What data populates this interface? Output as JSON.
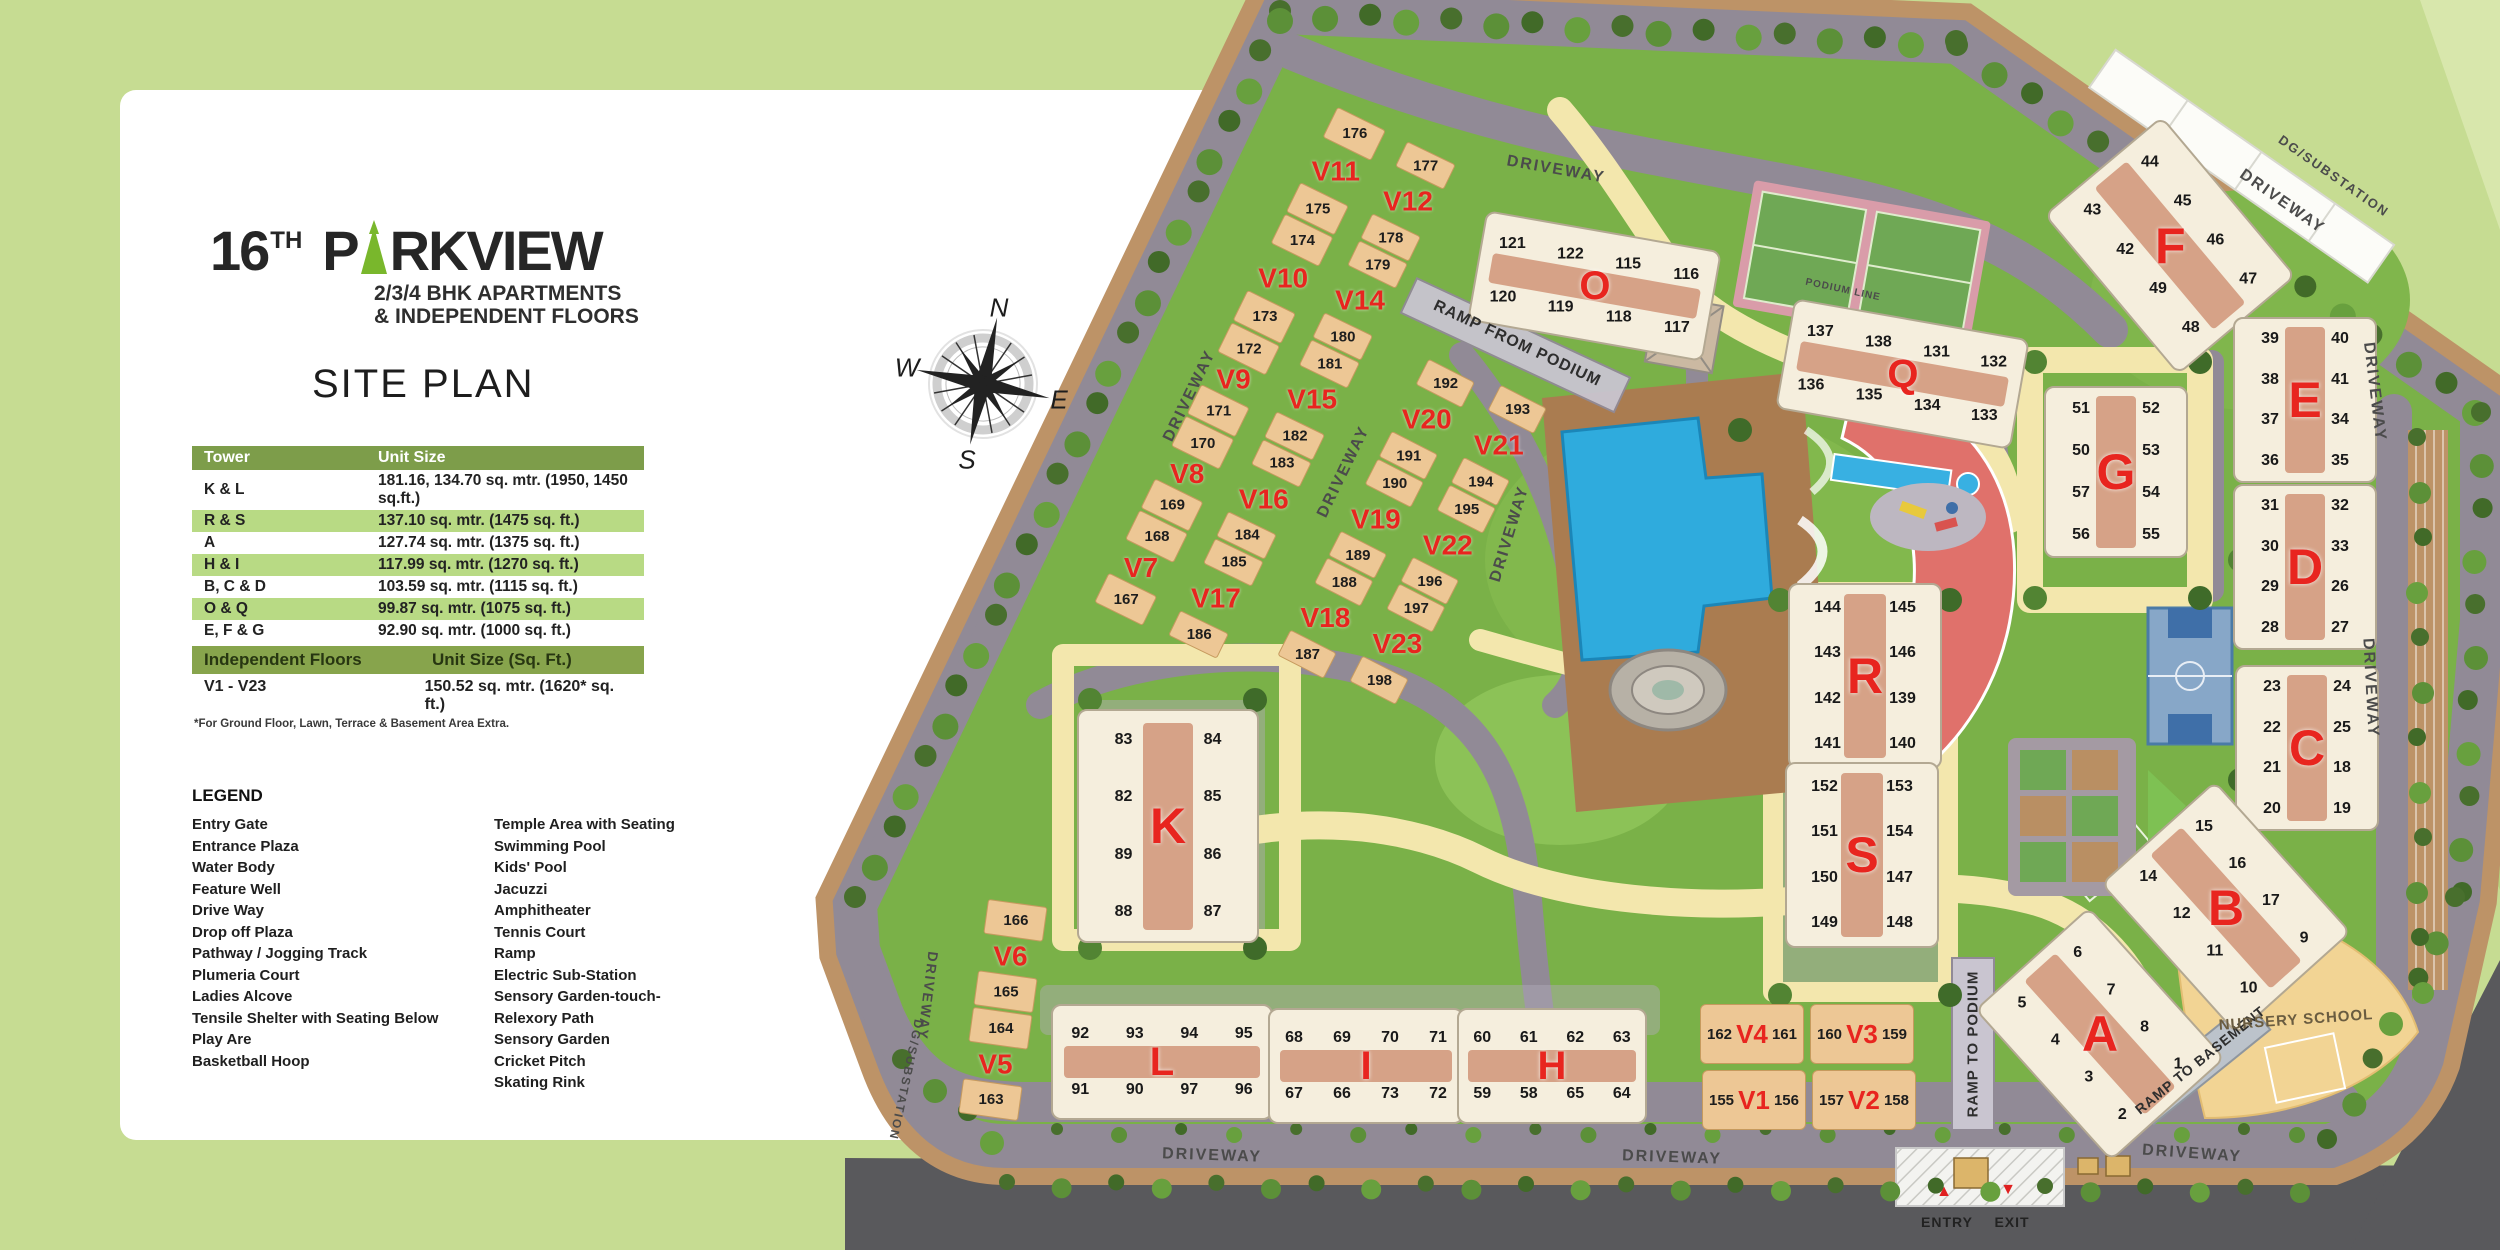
{
  "branding": {
    "title_num": "16",
    "title_sup": "TH",
    "title_p": "P",
    "title_rest": "RKVIEW",
    "subtitle1": "2/3/4 BHK APARTMENTS",
    "subtitle2": "& INDEPENDENT FLOORS",
    "accent_green": "#79b72c"
  },
  "site_plan_title": "SITE PLAN",
  "tower_table": {
    "headers": [
      "Tower",
      "Unit Size"
    ],
    "rows": [
      [
        "K & L",
        "181.16, 134.70 sq. mtr. (1950, 1450 sq.ft.)"
      ],
      [
        "R & S",
        "137.10 sq. mtr. (1475 sq. ft.)"
      ],
      [
        "A",
        "127.74 sq. mtr. (1375 sq. ft.)"
      ],
      [
        "H & I",
        "117.99 sq. mtr. (1270 sq. ft.)"
      ],
      [
        "B, C & D",
        "103.59 sq. mtr. (1115 sq. ft.)"
      ],
      [
        "O & Q",
        "99.87 sq. mtr. (1075 sq. ft.)"
      ],
      [
        "E, F & G",
        "92.90 sq. mtr. (1000 sq. ft.)"
      ]
    ]
  },
  "floors_table": {
    "header_left": "Independent Floors",
    "header_right": "Unit Size (Sq. Ft.)",
    "range": "V1 - V23",
    "size": "150.52 sq. mtr. (1620* sq. ft.)",
    "footnote": "*For Ground Floor, Lawn, Terrace & Basement Area Extra."
  },
  "legend": {
    "title": "LEGEND",
    "col1": [
      "Entry Gate",
      "Entrance Plaza",
      "Water Body",
      "Feature Well",
      "Drive Way",
      "Drop off Plaza",
      "Pathway / Jogging Track",
      "Plumeria Court",
      "Ladies Alcove",
      "Tensile Shelter with Seating Below",
      "Play Are",
      "Basketball Hoop"
    ],
    "col2": [
      "Temple Area with Seating",
      "Swimming Pool",
      "Kids' Pool",
      "Jacuzzi",
      "Amphitheater",
      "Tennis Court",
      "Ramp",
      "Electric Sub-Station",
      "Sensory Garden-touch-",
      "Relexory Path",
      "Sensory Garden",
      "Cricket Pitch",
      "Skating Rink"
    ]
  },
  "compass": {
    "n": "N",
    "e": "E",
    "s": "S",
    "w": "W"
  },
  "map": {
    "colors": {
      "lawn": "#7ab148",
      "road": "#918a96",
      "parking": "#bd9367",
      "track": "#f3e7ad",
      "building_tan": "#edc795",
      "tower_cream": "#f5eedd",
      "label_red": "#e8251f",
      "pool_blue": "#2fabdd",
      "clubhouse_red": "#e0716b",
      "dark_road": "#59595c"
    },
    "towers": [
      {
        "label": "O",
        "x": 1592,
        "y": 284,
        "w": 235,
        "h": 108,
        "a": 10,
        "cols": 4,
        "nums": [
          "121",
          "122",
          "115",
          "116",
          "120",
          "119",
          "118",
          "117"
        ]
      },
      {
        "label": "Q",
        "x": 1900,
        "y": 372,
        "w": 235,
        "h": 108,
        "a": 10,
        "cols": 4,
        "nums": [
          "137",
          "138",
          "131",
          "132",
          "136",
          "135",
          "134",
          "133"
        ]
      },
      {
        "label": "F",
        "x": 2168,
        "y": 243,
        "w": 150,
        "h": 205,
        "a": -40,
        "cols": 2,
        "nums": [
          "43",
          "44",
          "42",
          "45",
          "49",
          "46",
          "48",
          "47"
        ]
      },
      {
        "label": "E",
        "x": 2303,
        "y": 398,
        "w": 140,
        "h": 162,
        "a": 0,
        "cols": 2,
        "nums": [
          "39",
          "40",
          "38",
          "41",
          "37",
          "34",
          "36",
          "35"
        ]
      },
      {
        "label": "G",
        "x": 2114,
        "y": 470,
        "w": 140,
        "h": 168,
        "a": 0,
        "cols": 2,
        "nums": [
          "51",
          "52",
          "50",
          "53",
          "57",
          "54",
          "56",
          "55"
        ]
      },
      {
        "label": "D",
        "x": 2303,
        "y": 565,
        "w": 140,
        "h": 162,
        "a": 0,
        "cols": 2,
        "nums": [
          "31",
          "32",
          "30",
          "33",
          "29",
          "26",
          "28",
          "27"
        ]
      },
      {
        "label": "C",
        "x": 2305,
        "y": 746,
        "w": 140,
        "h": 162,
        "a": 0,
        "cols": 2,
        "nums": [
          "23",
          "24",
          "22",
          "25",
          "21",
          "18",
          "20",
          "19"
        ]
      },
      {
        "label": "B",
        "x": 2224,
        "y": 906,
        "w": 150,
        "h": 200,
        "a": -42,
        "cols": 2,
        "nums": [
          "14",
          "15",
          "12",
          "16",
          "11",
          "17",
          "10",
          "9"
        ]
      },
      {
        "label": "A",
        "x": 2098,
        "y": 1032,
        "w": 150,
        "h": 200,
        "a": -42,
        "cols": 2,
        "nums": [
          "5",
          "6",
          "4",
          "7",
          "3",
          "8",
          "2",
          "1"
        ]
      },
      {
        "label": "R",
        "x": 1863,
        "y": 674,
        "w": 150,
        "h": 182,
        "a": 0,
        "cols": 2,
        "nums": [
          "144",
          "145",
          "143",
          "146",
          "142",
          "139",
          "141",
          "140"
        ]
      },
      {
        "label": "S",
        "x": 1860,
        "y": 853,
        "w": 150,
        "h": 182,
        "a": 0,
        "cols": 2,
        "nums": [
          "152",
          "153",
          "151",
          "154",
          "150",
          "147",
          "149",
          "148"
        ]
      },
      {
        "label": "K",
        "x": 1166,
        "y": 824,
        "w": 178,
        "h": 230,
        "a": 0,
        "cols": 2,
        "nums": [
          "83",
          "84",
          "82",
          "85",
          "89",
          "86",
          "88",
          "87"
        ]
      },
      {
        "label": "L",
        "x": 1160,
        "y": 1060,
        "w": 218,
        "h": 112,
        "a": 0,
        "cols": 4,
        "nums": [
          "92",
          "93",
          "94",
          "95",
          "91",
          "90",
          "97",
          "96"
        ]
      },
      {
        "label": "I",
        "x": 1364,
        "y": 1064,
        "w": 192,
        "h": 112,
        "a": 0,
        "cols": 4,
        "nums": [
          "68",
          "69",
          "70",
          "71",
          "67",
          "66",
          "73",
          "72"
        ]
      },
      {
        "label": "H",
        "x": 1550,
        "y": 1064,
        "w": 186,
        "h": 112,
        "a": 0,
        "cols": 4,
        "nums": [
          "60",
          "61",
          "62",
          "63",
          "59",
          "58",
          "65",
          "64"
        ]
      }
    ],
    "v_strips": [
      {
        "x1": 1118,
        "y1": 615,
        "x2": 1362,
        "y2": 118,
        "w": 56,
        "items": [
          "167",
          "V7",
          "168",
          "169",
          "V8",
          "170",
          "171",
          "V9",
          "172",
          "173",
          "V10",
          "174",
          "175",
          "V11",
          "176"
        ]
      },
      {
        "x1": 1192,
        "y1": 648,
        "x2": 1432,
        "y2": 152,
        "w": 56,
        "items": [
          "186",
          "V17",
          "185",
          "184",
          "V16",
          "183",
          "182",
          "V15",
          "181",
          "180",
          "V14",
          "179",
          "178",
          "V12",
          "177"
        ]
      },
      {
        "x1": 1300,
        "y1": 668,
        "x2": 1452,
        "y2": 370,
        "w": 54,
        "items": [
          "187",
          "V18",
          "188",
          "189",
          "V19",
          "190",
          "191",
          "V20",
          "192"
        ]
      },
      {
        "x1": 1372,
        "y1": 694,
        "x2": 1524,
        "y2": 396,
        "w": 54,
        "items": [
          "198",
          "V23",
          "197",
          "196",
          "V22",
          "195",
          "194",
          "V21",
          "193"
        ]
      },
      {
        "x1": 988,
        "y1": 1118,
        "x2": 1018,
        "y2": 902,
        "w": 62,
        "items": [
          "163",
          "V5",
          "164",
          "165",
          "V6",
          "166"
        ]
      }
    ],
    "v_pairs": [
      {
        "label": "V4",
        "l": "162",
        "r": "161",
        "x": 1752,
        "y": 1034
      },
      {
        "label": "V3",
        "l": "160",
        "r": "159",
        "x": 1862,
        "y": 1034
      },
      {
        "label": "V1",
        "l": "155",
        "r": "156",
        "x": 1754,
        "y": 1100
      },
      {
        "label": "V2",
        "l": "157",
        "r": "158",
        "x": 1864,
        "y": 1100
      }
    ],
    "labels": [
      {
        "t": "DRIVEWAY",
        "x": 1190,
        "y": 396,
        "a": -64
      },
      {
        "t": "DRIVEWAY",
        "x": 1556,
        "y": 170,
        "a": 10
      },
      {
        "t": "DRIVEWAY",
        "x": 2282,
        "y": 202,
        "a": 35
      },
      {
        "t": "DG/SUBSTATION",
        "x": 2334,
        "y": 176,
        "a": 35,
        "s": 13
      },
      {
        "t": "DRIVEWAY",
        "x": 2374,
        "y": 392,
        "a": 83
      },
      {
        "t": "DRIVEWAY",
        "x": 2370,
        "y": 688,
        "a": 87
      },
      {
        "t": "DRIVEWAY",
        "x": 1344,
        "y": 472,
        "a": -64
      },
      {
        "t": "DRIVEWAY",
        "x": 1510,
        "y": 534,
        "a": -73
      },
      {
        "t": "DRIVEWAY",
        "x": 1212,
        "y": 1156,
        "a": 2
      },
      {
        "t": "DRIVEWAY",
        "x": 1672,
        "y": 1158,
        "a": 2
      },
      {
        "t": "DRIVEWAY",
        "x": 2192,
        "y": 1154,
        "a": 4
      },
      {
        "t": "DRIVEWAY",
        "x": 928,
        "y": 996,
        "a": 97,
        "s": 14
      },
      {
        "t": "DG/SUBSTATION",
        "x": 906,
        "y": 1080,
        "a": 102,
        "s": 12
      },
      {
        "t": "RAMP FROM PODIUM",
        "x": 1517,
        "y": 344,
        "a": 25,
        "s": 16,
        "c": "#2e2e2e",
        "ls": 1
      },
      {
        "t": "PODIUM LINE",
        "x": 1843,
        "y": 290,
        "a": 12,
        "s": 10,
        "ls": 1
      },
      {
        "t": "RAMP TO PODIUM",
        "x": 1973,
        "y": 1044,
        "a": -90,
        "s": 15,
        "c": "#2e2e2e",
        "ls": 1
      },
      {
        "t": "RAMP TO BASEMENT",
        "x": 2200,
        "y": 1060,
        "a": -39,
        "s": 14,
        "c": "#2e2e2e",
        "ls": 1
      },
      {
        "t": "NURSERY SCHOOL",
        "x": 2296,
        "y": 1020,
        "a": -4,
        "s": 15,
        "c": "#6a5c40",
        "ls": 1
      },
      {
        "t": "ENTRY",
        "x": 1947,
        "y": 1222,
        "a": 0,
        "s": 14,
        "c": "#222222",
        "ls": 1
      },
      {
        "t": "EXIT",
        "x": 2012,
        "y": 1222,
        "a": 0,
        "s": 14,
        "c": "#222222",
        "ls": 1
      },
      {
        "t": "▲",
        "x": 1944,
        "y": 1192,
        "a": 0,
        "s": 16,
        "c": "#e02020",
        "ls": 0
      },
      {
        "t": "▼",
        "x": 2008,
        "y": 1190,
        "a": 0,
        "s": 16,
        "c": "#e02020",
        "ls": 0
      }
    ]
  }
}
